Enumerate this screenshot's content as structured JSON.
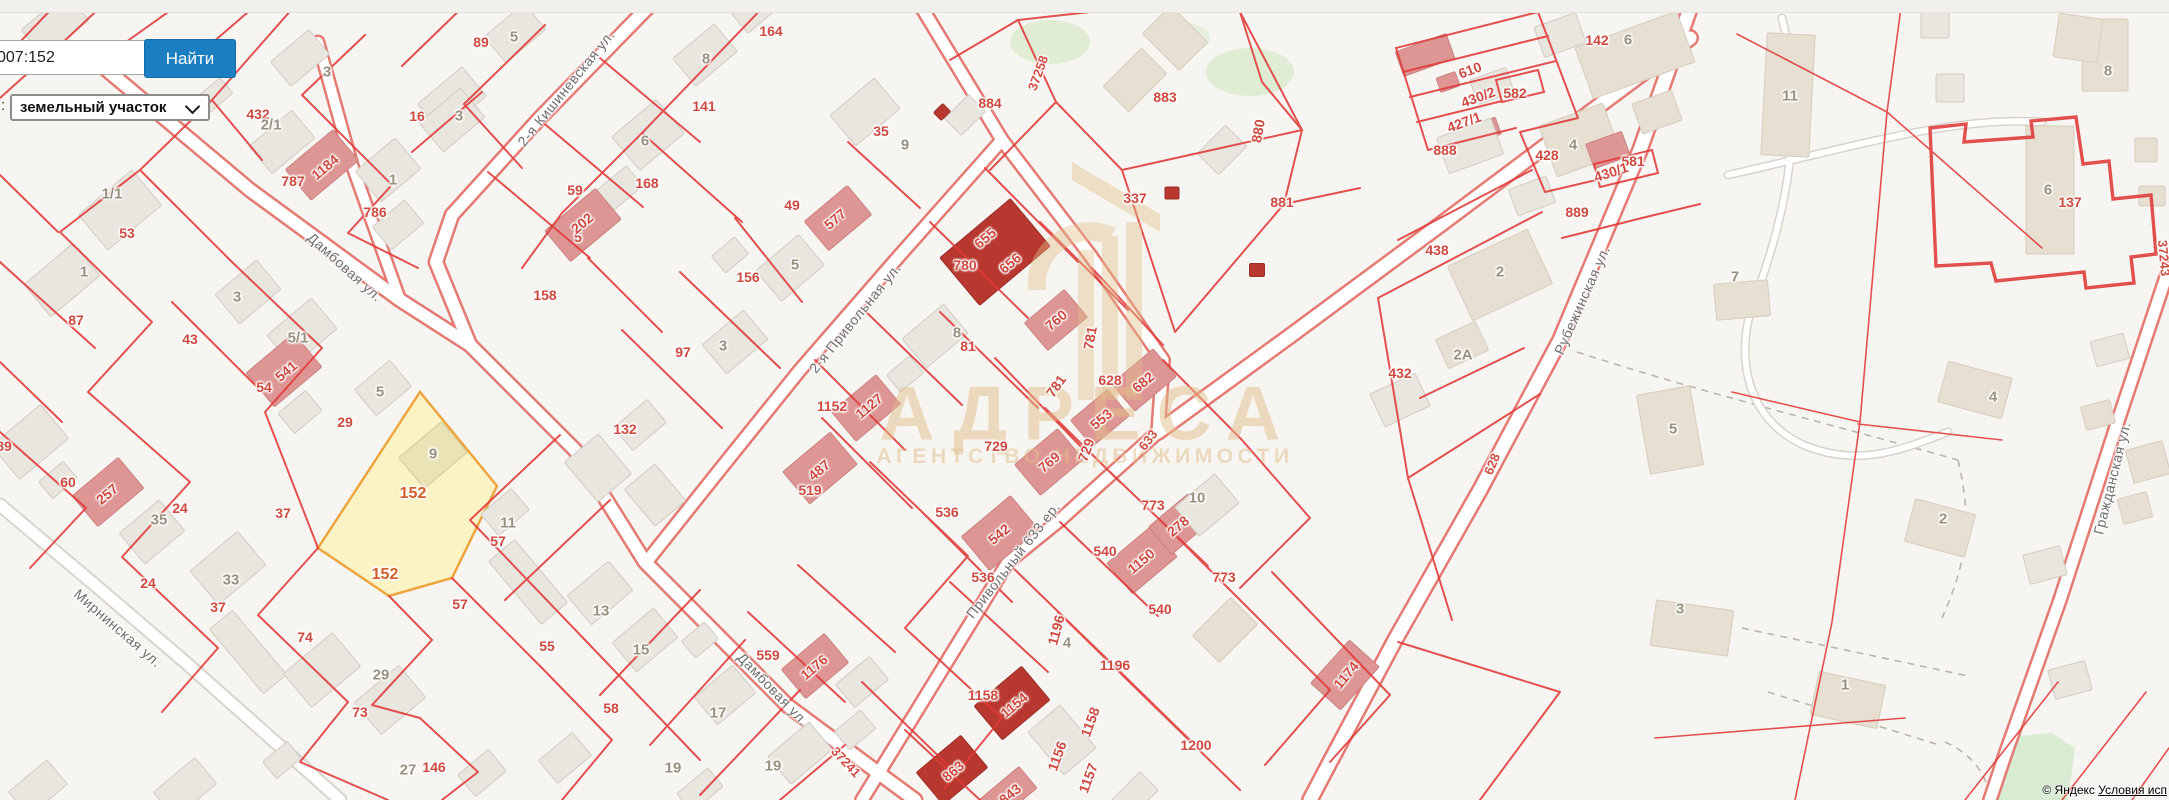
{
  "search": {
    "query_value": "007:152",
    "find_label": "Найти",
    "type_label": ":",
    "type_value": "земельный участок",
    "chevron_icon": "chevron-down"
  },
  "watermark": {
    "title": "АДРЕСА",
    "subtitle": "АГЕНТСТВО НЕДВИЖИМОСТИ"
  },
  "attribution": {
    "copyright": "© Яндекс",
    "terms_link": "Условия исп"
  },
  "colors": {
    "map_background": "#f7f5f1",
    "parcel_line": "#e03a38",
    "highlight_fill": "#fcf3c5",
    "highlight_border": "#eda53f",
    "button_blue": "#1a7ec1",
    "watermark_tan": "#e2bf8a"
  },
  "map_labels": {
    "streets": [
      {
        "t": "Дамбовая ул.",
        "x": 345,
        "y": 267,
        "r": 42
      },
      {
        "t": "Дамбовая ул.",
        "x": 773,
        "y": 689,
        "r": 46
      },
      {
        "t": "2-я Кишиневская ул.",
        "x": 566,
        "y": 88,
        "r": -51
      },
      {
        "t": "2-я Привольная ул.",
        "x": 855,
        "y": 318,
        "r": -51
      },
      {
        "t": "Привольный 633 ер.",
        "x": 1013,
        "y": 560,
        "r": -52
      },
      {
        "t": "Рубежинская ул.",
        "x": 1582,
        "y": 300,
        "r": -66
      },
      {
        "t": "Гражданская ул.",
        "x": 2112,
        "y": 478,
        "r": -76
      },
      {
        "t": "Мирнинская ул.",
        "x": 118,
        "y": 628,
        "r": 41
      }
    ],
    "road_numbers": [
      {
        "t": "37258",
        "x": 1038,
        "y": 73,
        "r": -70
      },
      {
        "t": "37241",
        "x": 846,
        "y": 762,
        "r": 47
      },
      {
        "t": "628",
        "x": 1492,
        "y": 464,
        "r": -67
      },
      {
        "t": "633",
        "x": 1148,
        "y": 440,
        "r": -52
      },
      {
        "t": "37243",
        "x": 2164,
        "y": 258,
        "r": 85
      }
    ],
    "parcels": [
      {
        "t": "432",
        "x": 258,
        "y": 114
      },
      {
        "t": "787",
        "x": 293,
        "y": 181
      },
      {
        "t": "1184",
        "x": 325,
        "y": 167,
        "r": -40
      },
      {
        "t": "786",
        "x": 375,
        "y": 212
      },
      {
        "t": "16",
        "x": 417,
        "y": 116
      },
      {
        "t": "53",
        "x": 127,
        "y": 233
      },
      {
        "t": "87",
        "x": 76,
        "y": 320
      },
      {
        "t": "43",
        "x": 190,
        "y": 339
      },
      {
        "t": "89",
        "x": 4,
        "y": 446
      },
      {
        "t": "60",
        "x": 68,
        "y": 482
      },
      {
        "t": "257",
        "x": 107,
        "y": 494,
        "r": -40
      },
      {
        "t": "541",
        "x": 286,
        "y": 371,
        "r": -40
      },
      {
        "t": "54",
        "x": 264,
        "y": 387
      },
      {
        "t": "24",
        "x": 180,
        "y": 508
      },
      {
        "t": "24",
        "x": 148,
        "y": 583
      },
      {
        "t": "37",
        "x": 283,
        "y": 513
      },
      {
        "t": "37",
        "x": 218,
        "y": 607
      },
      {
        "t": "29",
        "x": 345,
        "y": 422
      },
      {
        "t": "74",
        "x": 305,
        "y": 637
      },
      {
        "t": "73",
        "x": 360,
        "y": 712
      },
      {
        "t": "146",
        "x": 434,
        "y": 767
      },
      {
        "t": "57",
        "x": 498,
        "y": 541
      },
      {
        "t": "57",
        "x": 460,
        "y": 604
      },
      {
        "t": "55",
        "x": 547,
        "y": 646
      },
      {
        "t": "58",
        "x": 611,
        "y": 708
      },
      {
        "t": "89",
        "x": 481,
        "y": 42
      },
      {
        "t": "164",
        "x": 771,
        "y": 31
      },
      {
        "t": "141",
        "x": 704,
        "y": 106
      },
      {
        "t": "168",
        "x": 647,
        "y": 183
      },
      {
        "t": "59",
        "x": 575,
        "y": 190
      },
      {
        "t": "158",
        "x": 545,
        "y": 295
      },
      {
        "t": "5",
        "x": 578,
        "y": 237
      },
      {
        "t": "202",
        "x": 582,
        "y": 223,
        "r": -40
      },
      {
        "t": "49",
        "x": 792,
        "y": 205
      },
      {
        "t": "577",
        "x": 835,
        "y": 219,
        "r": -40
      },
      {
        "t": "35",
        "x": 881,
        "y": 131
      },
      {
        "t": "156",
        "x": 748,
        "y": 277
      },
      {
        "t": "97",
        "x": 683,
        "y": 352
      },
      {
        "t": "132",
        "x": 625,
        "y": 429
      },
      {
        "t": "1152",
        "x": 832,
        "y": 406
      },
      {
        "t": "1127",
        "x": 869,
        "y": 406,
        "r": -40
      },
      {
        "t": "519",
        "x": 810,
        "y": 490
      },
      {
        "t": "487",
        "x": 819,
        "y": 470,
        "r": -40
      },
      {
        "t": "81",
        "x": 968,
        "y": 346
      },
      {
        "t": "536",
        "x": 947,
        "y": 512
      },
      {
        "t": "542",
        "x": 999,
        "y": 534,
        "r": -40
      },
      {
        "t": "536",
        "x": 983,
        "y": 577
      },
      {
        "t": "559",
        "x": 768,
        "y": 655
      },
      {
        "t": "1176",
        "x": 814,
        "y": 667,
        "r": -40
      },
      {
        "t": "780",
        "x": 965,
        "y": 265
      },
      {
        "t": "655",
        "x": 985,
        "y": 238,
        "r": -40
      },
      {
        "t": "656",
        "x": 1010,
        "y": 263,
        "r": -40
      },
      {
        "t": "760",
        "x": 1056,
        "y": 320,
        "r": -40
      },
      {
        "t": "769",
        "x": 1049,
        "y": 462,
        "r": -40
      },
      {
        "t": "781",
        "x": 1090,
        "y": 338,
        "r": -80
      },
      {
        "t": "781",
        "x": 1056,
        "y": 386,
        "r": -55
      },
      {
        "t": "628",
        "x": 1110,
        "y": 380
      },
      {
        "t": "682",
        "x": 1143,
        "y": 382,
        "r": -40
      },
      {
        "t": "553",
        "x": 1101,
        "y": 419,
        "r": -40
      },
      {
        "t": "729",
        "x": 996,
        "y": 446
      },
      {
        "t": "729",
        "x": 1086,
        "y": 450,
        "r": -70
      },
      {
        "t": "337",
        "x": 1135,
        "y": 198
      },
      {
        "t": "883",
        "x": 1165,
        "y": 97
      },
      {
        "t": "884",
        "x": 990,
        "y": 103
      },
      {
        "t": "881",
        "x": 1282,
        "y": 202
      },
      {
        "t": "880",
        "x": 1258,
        "y": 131,
        "r": -80
      },
      {
        "t": "773",
        "x": 1153,
        "y": 505
      },
      {
        "t": "278",
        "x": 1178,
        "y": 526,
        "r": -40
      },
      {
        "t": "540",
        "x": 1105,
        "y": 551
      },
      {
        "t": "1150",
        "x": 1141,
        "y": 561,
        "r": -40
      },
      {
        "t": "773",
        "x": 1224,
        "y": 577
      },
      {
        "t": "540",
        "x": 1160,
        "y": 609
      },
      {
        "t": "1196",
        "x": 1056,
        "y": 630,
        "r": -75
      },
      {
        "t": "1196",
        "x": 1115,
        "y": 665
      },
      {
        "t": "1158",
        "x": 983,
        "y": 695
      },
      {
        "t": "1154",
        "x": 1014,
        "y": 705,
        "r": -40
      },
      {
        "t": "1158",
        "x": 1090,
        "y": 722,
        "r": -70
      },
      {
        "t": "1200",
        "x": 1196,
        "y": 745
      },
      {
        "t": "1156",
        "x": 1057,
        "y": 756,
        "r": -70
      },
      {
        "t": "1157",
        "x": 1088,
        "y": 778,
        "r": -70
      },
      {
        "t": "863",
        "x": 953,
        "y": 771,
        "r": -40
      },
      {
        "t": "843",
        "x": 1010,
        "y": 794,
        "r": -40
      },
      {
        "t": "1174",
        "x": 1346,
        "y": 675,
        "r": -50
      },
      {
        "t": "438",
        "x": 1437,
        "y": 250
      },
      {
        "t": "432",
        "x": 1400,
        "y": 373
      },
      {
        "t": "142",
        "x": 1597,
        "y": 40
      },
      {
        "t": "888",
        "x": 1445,
        "y": 150
      },
      {
        "t": "582",
        "x": 1515,
        "y": 93
      },
      {
        "t": "428",
        "x": 1547,
        "y": 155
      },
      {
        "t": "581",
        "x": 1633,
        "y": 161
      },
      {
        "t": "430/1",
        "x": 1611,
        "y": 172,
        "r": -18
      },
      {
        "t": "889",
        "x": 1577,
        "y": 212
      },
      {
        "t": "610",
        "x": 1470,
        "y": 70,
        "r": -20
      },
      {
        "t": "430/2",
        "x": 1478,
        "y": 97,
        "r": -20
      },
      {
        "t": "427/1",
        "x": 1464,
        "y": 122,
        "r": -20
      },
      {
        "t": "137",
        "x": 2070,
        "y": 202
      }
    ],
    "building_numbers": [
      {
        "t": "2/1",
        "x": 271,
        "y": 125
      },
      {
        "t": "1",
        "x": 393,
        "y": 180
      },
      {
        "t": "1/1",
        "x": 112,
        "y": 194
      },
      {
        "t": "1",
        "x": 84,
        "y": 272
      },
      {
        "t": "3",
        "x": 237,
        "y": 297
      },
      {
        "t": "3",
        "x": 327,
        "y": 72
      },
      {
        "t": "5/1",
        "x": 298,
        "y": 338
      },
      {
        "t": "5",
        "x": 380,
        "y": 392
      },
      {
        "t": "35",
        "x": 159,
        "y": 520
      },
      {
        "t": "33",
        "x": 231,
        "y": 580
      },
      {
        "t": "29",
        "x": 381,
        "y": 675
      },
      {
        "t": "27",
        "x": 408,
        "y": 770
      },
      {
        "t": "11",
        "x": 508,
        "y": 523
      },
      {
        "t": "13",
        "x": 601,
        "y": 611
      },
      {
        "t": "15",
        "x": 641,
        "y": 650
      },
      {
        "t": "17",
        "x": 718,
        "y": 713
      },
      {
        "t": "19",
        "x": 673,
        "y": 768
      },
      {
        "t": "19",
        "x": 773,
        "y": 766
      },
      {
        "t": "9",
        "x": 433,
        "y": 454
      },
      {
        "t": "5",
        "x": 514,
        "y": 37
      },
      {
        "t": "3",
        "x": 459,
        "y": 116
      },
      {
        "t": "8",
        "x": 706,
        "y": 59
      },
      {
        "t": "6",
        "x": 645,
        "y": 141
      },
      {
        "t": "9",
        "x": 905,
        "y": 145
      },
      {
        "t": "5",
        "x": 795,
        "y": 265
      },
      {
        "t": "3",
        "x": 723,
        "y": 346
      },
      {
        "t": "8",
        "x": 957,
        "y": 333
      },
      {
        "t": "10",
        "x": 1197,
        "y": 498
      },
      {
        "t": "4",
        "x": 1067,
        "y": 643
      },
      {
        "t": "2",
        "x": 1500,
        "y": 272
      },
      {
        "t": "2А",
        "x": 1463,
        "y": 355
      },
      {
        "t": "6",
        "x": 1628,
        "y": 40
      },
      {
        "t": "4",
        "x": 1573,
        "y": 145
      },
      {
        "t": "11",
        "x": 1790,
        "y": 96
      },
      {
        "t": "8",
        "x": 2108,
        "y": 71
      },
      {
        "t": "7",
        "x": 1735,
        "y": 277
      },
      {
        "t": "6",
        "x": 2048,
        "y": 190
      },
      {
        "t": "5",
        "x": 1673,
        "y": 429
      },
      {
        "t": "4",
        "x": 1993,
        "y": 397
      },
      {
        "t": "2",
        "x": 1943,
        "y": 519
      },
      {
        "t": "3",
        "x": 1680,
        "y": 609
      },
      {
        "t": "1",
        "x": 1845,
        "y": 685
      }
    ],
    "highlight_labels": [
      {
        "t": "152",
        "x": 413,
        "y": 494
      },
      {
        "t": "152",
        "x": 385,
        "y": 575
      }
    ]
  },
  "highlight_parcel": {
    "number": "152",
    "points": "420,392 497,486 452,578 389,596 318,548"
  }
}
